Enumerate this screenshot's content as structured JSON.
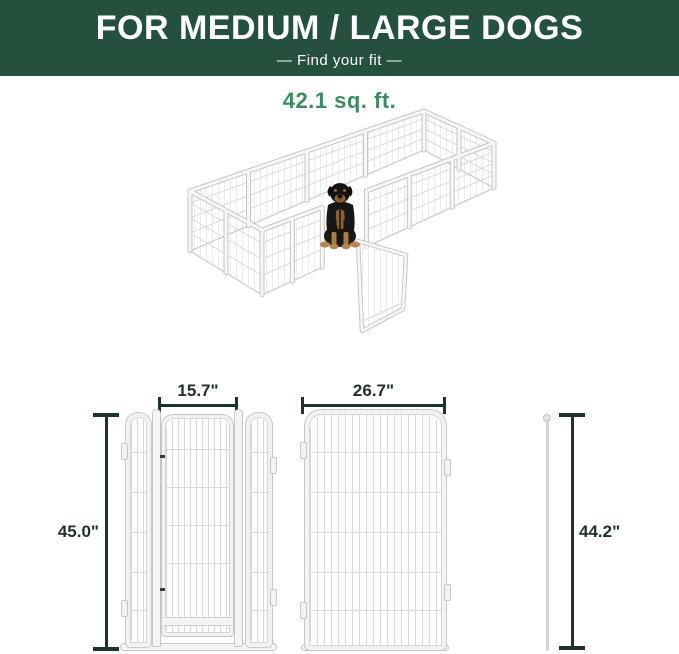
{
  "banner": {
    "title": "FOR MEDIUM / LARGE DOGS",
    "subtitle": "—  Find your fit  —",
    "bg_color": "#25503d",
    "text_color": "#ffffff"
  },
  "area": {
    "value": "42.1 sq. ft.",
    "accent_color": "#3d8c62"
  },
  "illustration": {
    "description": "white-wire-playpen-3d-view-with-rottweiler-dog-and-open-door"
  },
  "diagram": {
    "door_width": "15.7\"",
    "panel_width": "26.7\"",
    "door_height": "45.0\"",
    "rod_height": "44.2\"",
    "dimension_line_color": "#1e3429"
  }
}
